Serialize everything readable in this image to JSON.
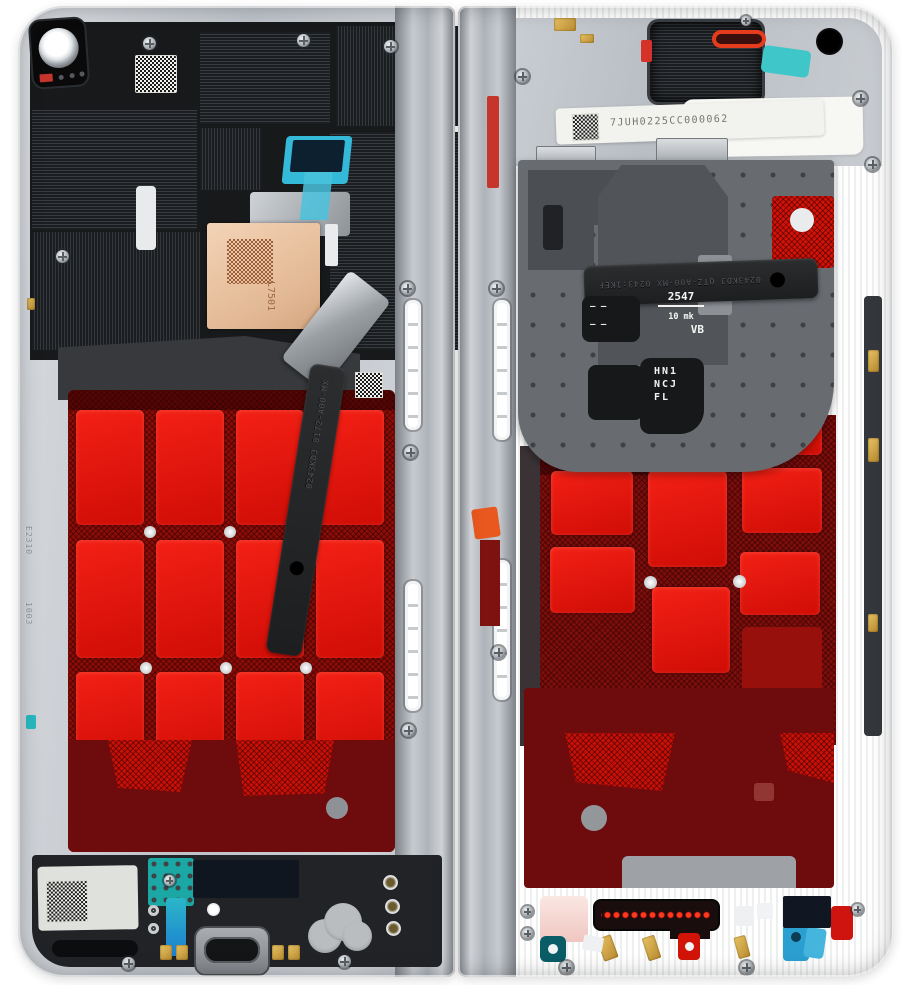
{
  "scene": {
    "background": "#ffffff",
    "subject": "foldable phone frame halves, internal view"
  },
  "left_half": {
    "flex_strip_marking": "0243KDJ 0172-A00-MX",
    "copper_pad_marking": "L7501",
    "frame_marking_a": "E2310",
    "frame_marking_b": "1003"
  },
  "right_half": {
    "serial_label": "7JUH0225CC000062",
    "flex_strip_marking": "0243KDJ QTZ-A00-MX 0243:1KEF",
    "speaker_markings": {
      "dashes": "— —",
      "line1": "2547",
      "line2": "10 mk",
      "line3": "VB"
    },
    "module_markings": {
      "line1": "HN1",
      "line2": "NCJ",
      "line3": "FL"
    }
  },
  "palette": {
    "frame_silver": "#c7cbd1",
    "shield_black": "#1d2023",
    "adhesive_red_bright": "#e01309",
    "adhesive_red_dark": "#7c0e0c",
    "adhesive_maroon": "#6e0b0d",
    "copper": "#e9c3a4",
    "teal": "#27b9c0",
    "blue": "#2aa5d6",
    "gold": "#cfa33f",
    "label_white": "#f2f2ee",
    "pink": "#f4d3cd"
  }
}
